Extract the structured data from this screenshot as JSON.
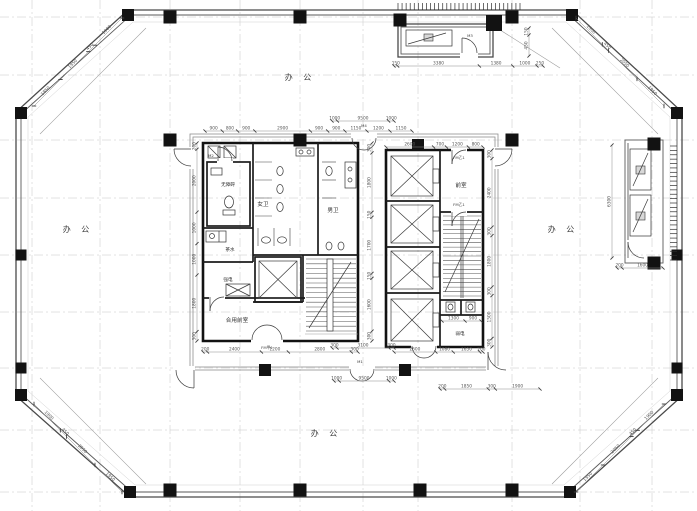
{
  "colors": {
    "wall": "#121212",
    "outer": "#4a4a4a",
    "dimension": "#8a8a8a",
    "background": "#ffffff"
  },
  "labels": {
    "office_top": "办 公",
    "office_left": "办 公",
    "office_right": "办 公",
    "office_bottom": "办 公",
    "accessible_wc": "无障碍",
    "women_wc": "女卫",
    "men_wc": "男卫",
    "pantry": "茶水",
    "strong_electric": "强电",
    "shared_lobby": "合用前室",
    "lobby": "前室",
    "weak_electric": "弱电"
  },
  "door_tags": {
    "m1": "M1",
    "m2": "M2",
    "m3": "M3",
    "m4": "M4",
    "fm_jia": "FM甲1",
    "fm_yi_top": "FM乙1",
    "fm_yi_mid": "FM乙1"
  },
  "dims": {
    "top_room": [
      "150",
      "3380",
      "1380",
      "1000",
      "250"
    ],
    "top_room_v": [
      "450",
      "150"
    ],
    "corridor_top": [
      "1000",
      "9500",
      "1000"
    ],
    "left_core_top": [
      "900",
      "800",
      "900",
      "2900",
      "900",
      "900",
      "1150",
      "1200",
      "1150"
    ],
    "right_core_top": [
      "2600",
      "700",
      "1200",
      "800"
    ],
    "left_core_left": [
      "300",
      "1800",
      "1000",
      "1000",
      "2000",
      "200"
    ],
    "corridor_mid": [
      "300",
      "1600",
      "150",
      "1700",
      "150",
      "1800",
      "300"
    ],
    "right_core_right": [
      "300",
      "1500",
      "300",
      "1800",
      "300",
      "2400",
      "300"
    ],
    "bottom_left_core": [
      "200",
      "2400",
      "1200",
      "2800",
      "300"
    ],
    "bottom_mid": [
      "300",
      "3100",
      "300"
    ],
    "bottom_right_core": [
      "2600",
      "1080",
      "1650",
      "200"
    ],
    "bottom_corridor": [
      "1000",
      "9500",
      "1000"
    ],
    "bottom_right": [
      "200",
      "1850",
      "300",
      "1900"
    ],
    "right_shaft_v": [
      "6300"
    ],
    "right_shaft_b": [
      "200",
      "1600"
    ],
    "weak_room": [
      "1300",
      "900"
    ],
    "diag_tl": [
      "1850",
      "1950",
      "450",
      "1900"
    ],
    "diag_tr": [
      "1900",
      "450",
      "2050",
      "1950"
    ],
    "diag_bl": [
      "1900",
      "450",
      "2050",
      "1950"
    ],
    "diag_br": [
      "1950",
      "2050",
      "450",
      "1900"
    ]
  }
}
